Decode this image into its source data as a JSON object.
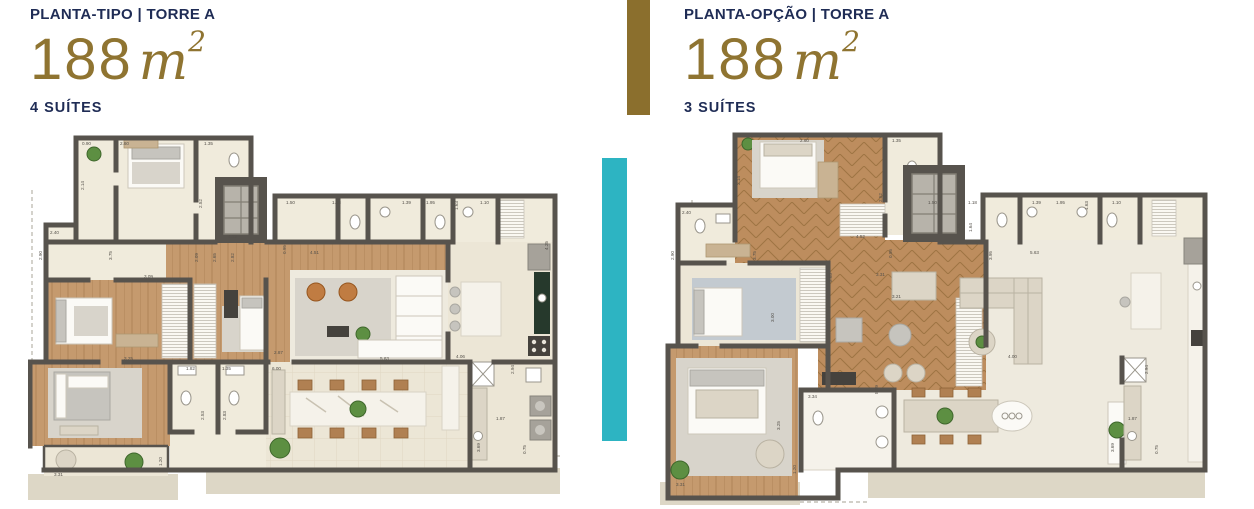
{
  "panels": {
    "left": {
      "eyebrow": "PLANTA-TIPO | TORRE A",
      "area": "188",
      "unit": "m",
      "sup": "2",
      "suites": "4 SUÍTES"
    },
    "right": {
      "eyebrow": "PLANTA-OPÇÃO | TORRE A",
      "area": "188",
      "unit": "m",
      "sup": "2",
      "suites": "3 SUÍTES"
    }
  },
  "colors": {
    "gold_accent": "#8B6F2D",
    "teal_accent": "#2DB4C2",
    "navy_text": "#1F2C55",
    "wall": "#57534D",
    "wood_floor": "#C59A6E",
    "herringbone_wood": "#BD8D5E",
    "tile_floor": "#F0EBDC",
    "terrace_tile": "#ECE6D6",
    "armchair_orange": "#C07C42",
    "kitchen_counter_green": "#26392C",
    "outer_deck": "#DDD7C6"
  },
  "left_plan": {
    "name": "planta-tipo floor plan",
    "dims": [
      "0.90",
      "2.60",
      "1.35",
      "2.14",
      "2.52",
      "2.40",
      "3.75",
      "4.12",
      "1.50",
      "1.18",
      "1.39",
      "1.95",
      "1.63",
      "1.10",
      "2.90",
      "2.09",
      "2.65",
      "2.82",
      "3.09",
      "4.51",
      "0.95",
      "5.63",
      "4.06",
      "2.87",
      "1.82",
      "1.35",
      "6.00",
      "3.25",
      "2.53",
      "2.83",
      "3.31",
      "1.20",
      "1.87",
      "0.75",
      "3.69",
      "2.94",
      "4.25"
    ]
  },
  "right_plan": {
    "name": "planta-opção floor plan",
    "dims": [
      "2.60",
      "1.35",
      "2.14",
      "2.52",
      "2.40",
      "3.75",
      "4.52",
      "1.50",
      "1.18",
      "1.61",
      "1.64",
      "1.39",
      "1.95",
      "1.63",
      "1.10",
      "2.90",
      "0.95",
      "3.31",
      "3.21",
      "2.65",
      "3.00",
      "5.63",
      "3.95",
      "4.00",
      "2.94",
      "3.34",
      "3.25",
      "3.31",
      "1.20",
      "8.09",
      "3.69",
      "0.75",
      "1.87"
    ]
  }
}
